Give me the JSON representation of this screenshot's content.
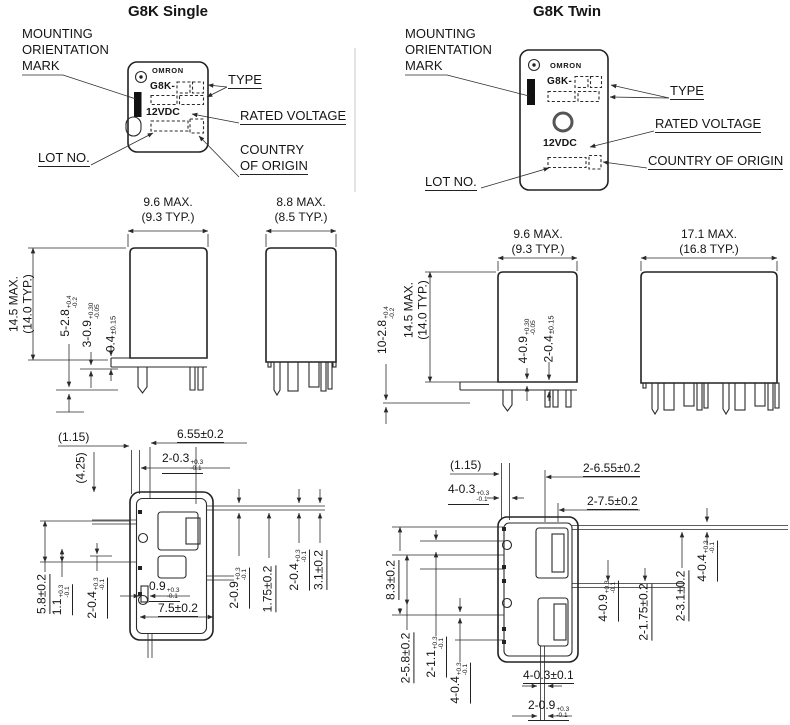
{
  "single": {
    "title": "G8K Single",
    "face": {
      "brand": "OMRON",
      "model": "G8K-",
      "voltage": "12VDC"
    },
    "callouts": {
      "mounting1": "MOUNTING",
      "mounting2": "ORIENTATION",
      "mounting3": "MARK",
      "type": "TYPE",
      "rated_voltage": "RATED VOLTAGE",
      "lot_no": "LOT NO.",
      "country1": "COUNTRY",
      "country2": "OF ORIGIN"
    },
    "side_view": {
      "width_max": "9.6 MAX.",
      "width_typ": "(9.3 TYP.)",
      "height_max": "14.5 MAX.",
      "height_typ": "(14.0 TYP.)",
      "dim_terminal_w": {
        "main": "5-2.8",
        "sup": "+0.4",
        "sub": "-0.2"
      },
      "dim_terminal_t": {
        "main": "3-0.9",
        "sup": "+0.30",
        "sub": "-0.05"
      },
      "dim_standoff": {
        "main": "0.4",
        "tol": "±0.15"
      }
    },
    "front_view": {
      "width_max": "8.8 MAX.",
      "width_typ": "(8.5 TYP.)"
    },
    "bottom_view": {
      "offset_x": "(1.15)",
      "offset_y": "(4.25)",
      "dim_655": "6.55±0.2",
      "dim_03": {
        "main": "2-0.3",
        "sup": "+0.3",
        "sub": "-0.1"
      },
      "dim_58": "5.8±0.2",
      "dim_11": {
        "main": "1.1",
        "sup": "+0.3",
        "sub": "-0.1"
      },
      "dim_04L": {
        "main": "2-0.4",
        "sup": "+0.3",
        "sub": "-0.1"
      },
      "dim_09b": {
        "main": "0.9",
        "sup": "+0.3",
        "sub": "-0.1"
      },
      "dim_75": "7.5±0.2",
      "dim_09r": {
        "main": "2-0.9",
        "sup": "+0.3",
        "sub": "-0.1"
      },
      "dim_175": "1.75±0.2",
      "dim_04R": {
        "main": "2-0.4",
        "sup": "+0.3",
        "sub": "-0.1"
      },
      "dim_31": "3.1±0.2"
    }
  },
  "twin": {
    "title": "G8K Twin",
    "face": {
      "brand": "OMRON",
      "model": "G8K-",
      "voltage": "12VDC"
    },
    "callouts": {
      "mounting1": "MOUNTING",
      "mounting2": "ORIENTATION",
      "mounting3": "MARK",
      "type": "TYPE",
      "rated_voltage": "RATED VOLTAGE",
      "lot_no": "LOT NO.",
      "country": "COUNTRY OF ORIGIN"
    },
    "side_view": {
      "width_max": "9.6 MAX.",
      "width_typ": "(9.3 TYP.)",
      "height_max": "14.5 MAX.",
      "height_typ": "(14.0 TYP.)",
      "dim_terminal_w": {
        "main": "10-2.8",
        "sup": "+0.4",
        "sub": "-0.2"
      },
      "dim_terminal_t": {
        "main": "4-0.9",
        "sup": "+0.30",
        "sub": "-0.05"
      },
      "dim_standoff": {
        "main": "2-0.4",
        "tol": "±0.15"
      }
    },
    "front_view": {
      "width_max": "17.1 MAX.",
      "width_typ": "(16.8 TYP.)"
    },
    "bottom_view": {
      "offset_x": "(1.15)",
      "dim_655": "2-6.55±0.2",
      "dim_03": {
        "main": "4-0.3",
        "sup": "+0.3",
        "sub": "-0.1"
      },
      "dim_75": "2-7.5±0.2",
      "dim_83": "8.3±0.2",
      "dim_58": "2-5.8±0.2",
      "dim_11": {
        "main": "2-1.1",
        "sup": "+0.3",
        "sub": "-0.1"
      },
      "dim_04L": {
        "main": "4-0.4",
        "sup": "+0.3",
        "sub": "-0.1"
      },
      "dim_03b": "4-0.3±0.1",
      "dim_09b": {
        "main": "2-0.9",
        "sup": "+0.3",
        "sub": "-0.1"
      },
      "dim_09r": {
        "main": "4-0.9",
        "sup": "+0.3",
        "sub": "-0.1"
      },
      "dim_175": "2-1.75±0.2",
      "dim_31": "2-3.1±0.2",
      "dim_04R": {
        "main": "4-0.4",
        "sup": "+0.3",
        "sub": "-0.1"
      }
    }
  }
}
